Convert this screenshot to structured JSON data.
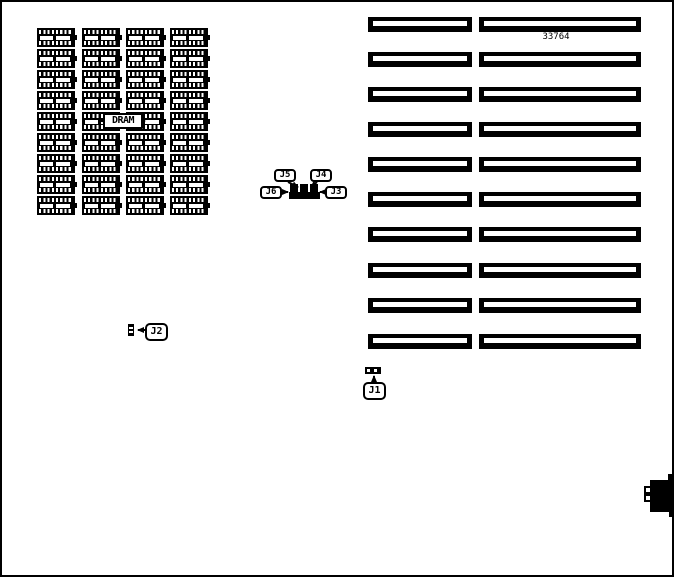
{
  "diagram_type": "circuit-board jumper location diagram",
  "part_number": "33764",
  "labels": {
    "dram": "DRAM",
    "j1": "J1",
    "j2": "J2",
    "j3": "J3",
    "j4": "J4",
    "j5": "J5",
    "j6": "J6"
  },
  "dram_grid": {
    "columns": 4,
    "rows": 9,
    "total_chips": 36,
    "description": "grid of DRAM chip symbols, DRAM flag label overlaid on center row"
  },
  "slots": {
    "rows": 10,
    "columns": 2,
    "total": 20,
    "description": "two columns of horizontal expansion-slot symbols on right half"
  },
  "jumpers": {
    "cluster": [
      "J5",
      "J4",
      "J6",
      "J3"
    ],
    "standalone": [
      "J2",
      "J1"
    ]
  },
  "edge_connector": {
    "position": "right edge",
    "pin_notches": 2
  },
  "colors": {
    "ink": "#000000",
    "paper": "#ffffff"
  }
}
